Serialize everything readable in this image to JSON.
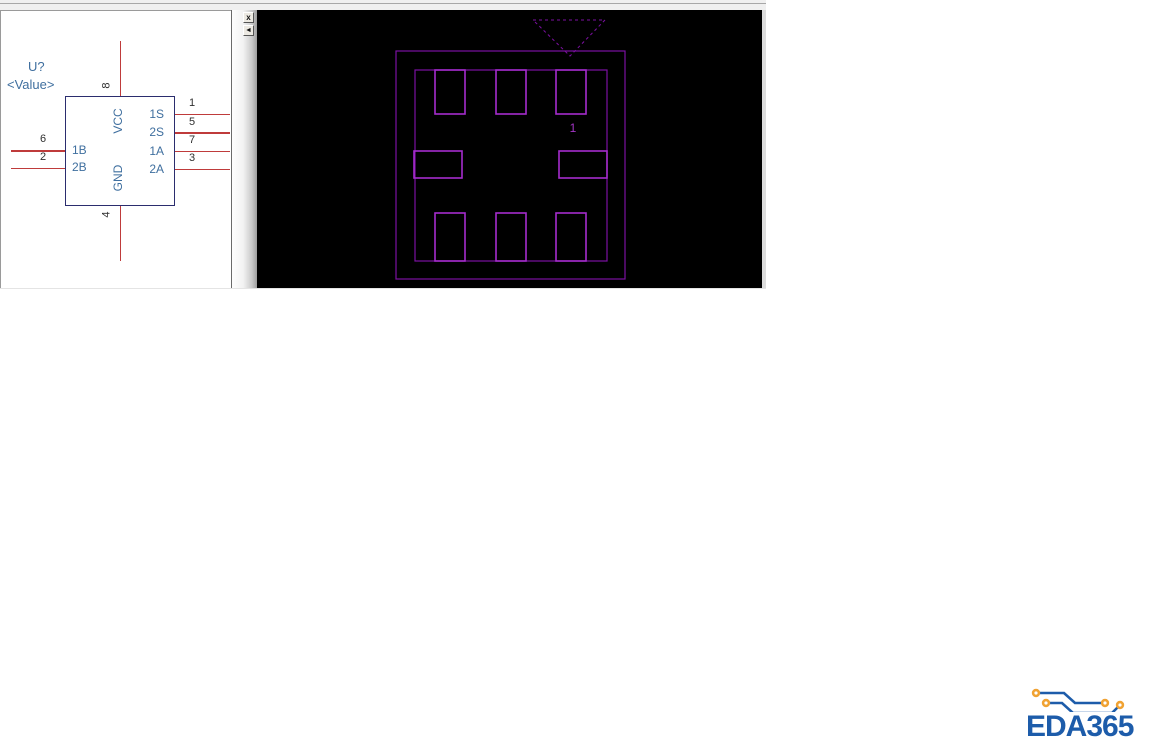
{
  "window": {
    "description": "EDA component preview: schematic symbol (left) and PCB footprint (right)"
  },
  "colors": {
    "wire_red": "#bf3b3b",
    "symbol_border_navy": "#2b2d6e",
    "symbol_text_blue": "#3f6f9f",
    "pin_number_dark": "#2f2f2f",
    "footprint_outline_purple": "#7c10a2",
    "footprint_pad_purple": "#a52ccd",
    "footprint_background": "#000000",
    "logo_blue": "#1d5caa",
    "logo_via_orange": "#f0a232"
  },
  "schematic": {
    "designator": "U?",
    "value_placeholder": "<Value>",
    "pin_top": {
      "number": "8",
      "name": "VCC"
    },
    "pin_bottom": {
      "number": "4",
      "name": "GND"
    },
    "pins_left": [
      {
        "number": "6",
        "name": "1B"
      },
      {
        "number": "2",
        "name": "2B"
      }
    ],
    "pins_right": [
      {
        "number": "1",
        "name": "1S"
      },
      {
        "number": "5",
        "name": "2S"
      },
      {
        "number": "7",
        "name": "1A"
      },
      {
        "number": "3",
        "name": "2A"
      }
    ]
  },
  "splitter": {
    "close_label": "x",
    "collapse_label": "◄"
  },
  "footprint": {
    "pad1_label": "1"
  },
  "logo": {
    "text": "EDA365"
  }
}
